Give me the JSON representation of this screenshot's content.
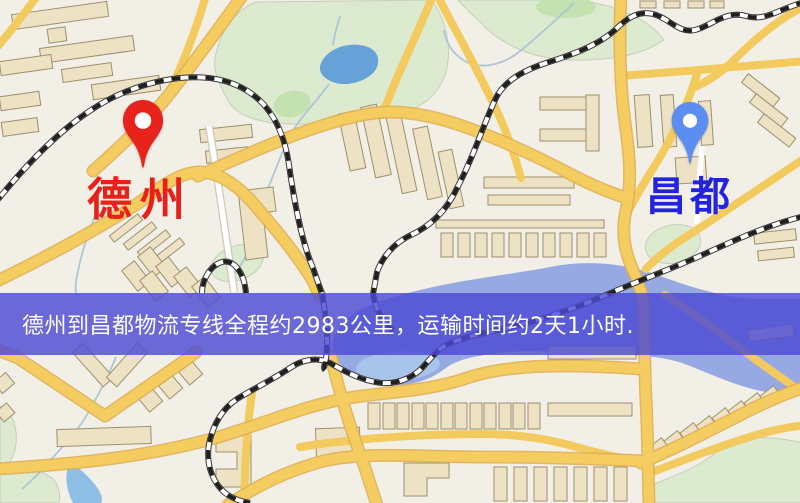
{
  "markers": {
    "origin": {
      "label": "德州",
      "label_color": "#e8201a",
      "pin_color": "#e8231c"
    },
    "destination": {
      "label": "昌都",
      "label_color": "#2222e0",
      "pin_color": "#5c8ef2"
    }
  },
  "banner": {
    "text": "德州到昌都物流专线全程约2983公里，运输时间约2天1小时.",
    "distance_km": "2983",
    "duration": "2天1小时",
    "background_color": "#4d4ad4",
    "text_color": "#ffffff"
  },
  "map_palette": {
    "base": "#f2efe7",
    "road_major": "#f4cc60",
    "road_minor": "#f2ca5e",
    "park": "#dcead0",
    "lake": "#66a1d8",
    "river": "#96a9e2",
    "building": "#ede2c4",
    "railway": "#1f1f1f"
  }
}
